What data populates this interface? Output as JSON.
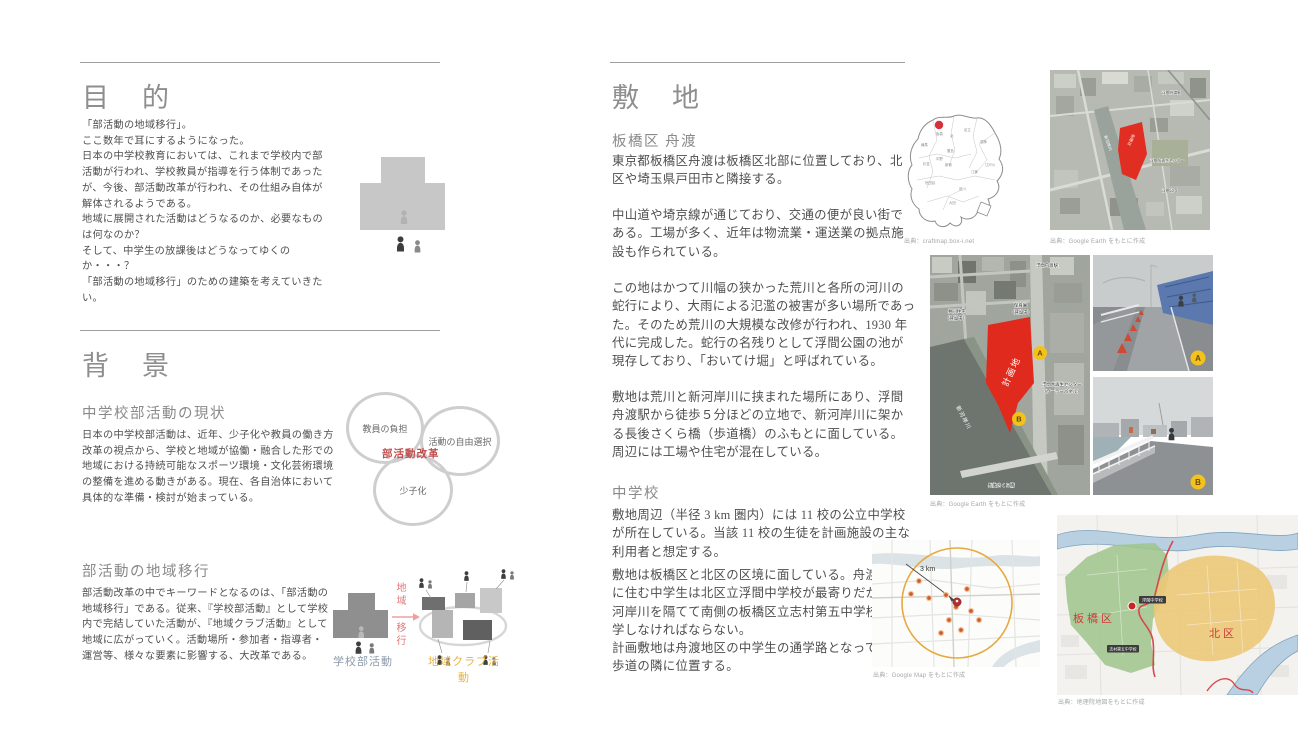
{
  "purpose": {
    "title": "目　的",
    "body": "「部活動の地域移行」。\nここ数年で耳にするようになった。\n日本の中学校教育においては、これまで学校内で部\n活動が行われ、学校教員が指導を行う体制であった\nが、今後、部活動改革が行われ、その仕組み自体が\n解体されるようである。\n地域に展開された活動はどうなるのか、必要なもの\nは何なのか？\nそして、中学生の放課後はどうなってゆくのか・・・？\n「部活動の地域移行」のための建築を考えていきたい。"
  },
  "background": {
    "title": "背　景",
    "current": {
      "heading": "中学校部活動の現状",
      "body": "日本の中学校部活動は、近年、少子化や教員の働き方\n改革の視点から、学校と地域が協働・融合した形での\n地域における持続可能なスポーツ環境・文化芸術環境\nの整備を進める動きがある。現在、各自治体において\n具体的な準備・検討が始まっている。"
    },
    "venn": {
      "teacher": "教員の負担",
      "choice": "活動の自由選択",
      "birthrate": "少子化",
      "center": "部活動改革"
    },
    "shift": {
      "heading": "部活動の地域移行",
      "body": "部活動改革の中でキーワードとなるのは、「部活動の\n地域移行」である。従来、『学校部活動』として学校\n内で完結していた活動が、『地域クラブ活動』として\n地域に広がっていく。活動場所・参加者・指導者・\n運営等、様々な要素に影響する、大改革である。",
      "diagram": {
        "school_label": "学校部活動",
        "arrow_word_1": "地域",
        "arrow_word_2": "移行",
        "club_label": "地域クラブ活動"
      }
    }
  },
  "site": {
    "title": "敷　地",
    "funado": {
      "heading": "板橋区 舟渡",
      "p1": "東京都板橋区舟渡は板橋区北部に位置しており、北\n区や埼玉県戸田市と隣接する。",
      "p2": "中山道や埼京線が通じており、交通の便が良い街で\nある。工場が多く、近年は物流業・運送業の拠点施\n設も作られている。",
      "p3": "この地はかつて川幅の狭かった荒川と各所の河川の\n蛇行により、大雨による氾濫の被害が多い場所であっ\nた。そのため荒川の大規模な改修が行われ、1930 年\n代に完成した。蛇行の名残りとして浮間公園の池が\n現存しており、「おいてけ堀」と呼ばれている。",
      "p4": "敷地は荒川と新河岸川に挟まれた場所にあり、浮間\n舟渡駅から徒歩５分ほどの立地で、新河岸川に架か\nる長後さくら橋（歩道橋）のふもとに面している。\n周辺には工場や住宅が混在している。"
    },
    "school": {
      "heading": "中学校",
      "p1": "敷地周辺（半径 3 km 圏内）には 11 校の公立中学校\nが所在している。当該 11 校の生徒を計画施設の主な\n利用者と想定する。",
      "p2": "敷地は板橋区と北区の区境に面している。舟渡地区\nに住む中学生は北区立浮間中学校が最寄りだが、新\n河岸川を隔てて南側の板橋区立志村第五中学校へ通\n学しなければならない。\n計画敷地は舟渡地区の中学生の通学路となっている\n歩道の隣に位置する。"
    },
    "ward_map": {
      "caption": "出典：craftmap.box-i.net",
      "wards": [
        "板橋",
        "練馬",
        "北",
        "足立",
        "葛飾",
        "豊島",
        "中野",
        "杉並",
        "新宿",
        "江戸川",
        "世田谷",
        "大田",
        "品川",
        "江東"
      ]
    },
    "top_sat": {
      "caption": "出典：Google Earth をもとに作成",
      "labels": {
        "station": "浮間舟渡駅",
        "site": "計画地",
        "river": "新河岸川",
        "center": "浮間水再生センター",
        "park": "浮間公園"
      }
    },
    "aerial": {
      "caption": "出典：Google Earth をもとに作成",
      "labels": {
        "station": "浮間舟渡駅↑",
        "nursery1": "保育園",
        "nursery2": "（建設中）",
        "housing1": "共同住宅",
        "housing2": "（建設中）",
        "site": "計画地",
        "center1": "浮間水再生センター",
        "center2": "（ソーラーパネル）",
        "river": "新河岸川",
        "bridge": "長後さくら橋",
        "a": "A",
        "b": "B"
      }
    },
    "photos": {
      "a_label": "A",
      "b_label": "B"
    },
    "radius_map": {
      "caption": "出典：Google Map をもとに作成",
      "radius_label": "3 km"
    },
    "district_map": {
      "caption": "出典：地理院地図をもとに作成",
      "itabashi": "板橋区",
      "kita": "北区",
      "school_near": "浮間中学校",
      "school_far": "志村第五中学校"
    }
  },
  "colors": {
    "site_red": "#e02a1d",
    "marker_yellow": "#f2c21c",
    "venn_red": "#c05050",
    "arrow_pink": "#ee9f9f",
    "school_label_blue": "#8e99ab",
    "club_label_orange": "#e5b44a",
    "itabashi_green": "#9dc68b",
    "kita_orange": "#ecc878"
  }
}
